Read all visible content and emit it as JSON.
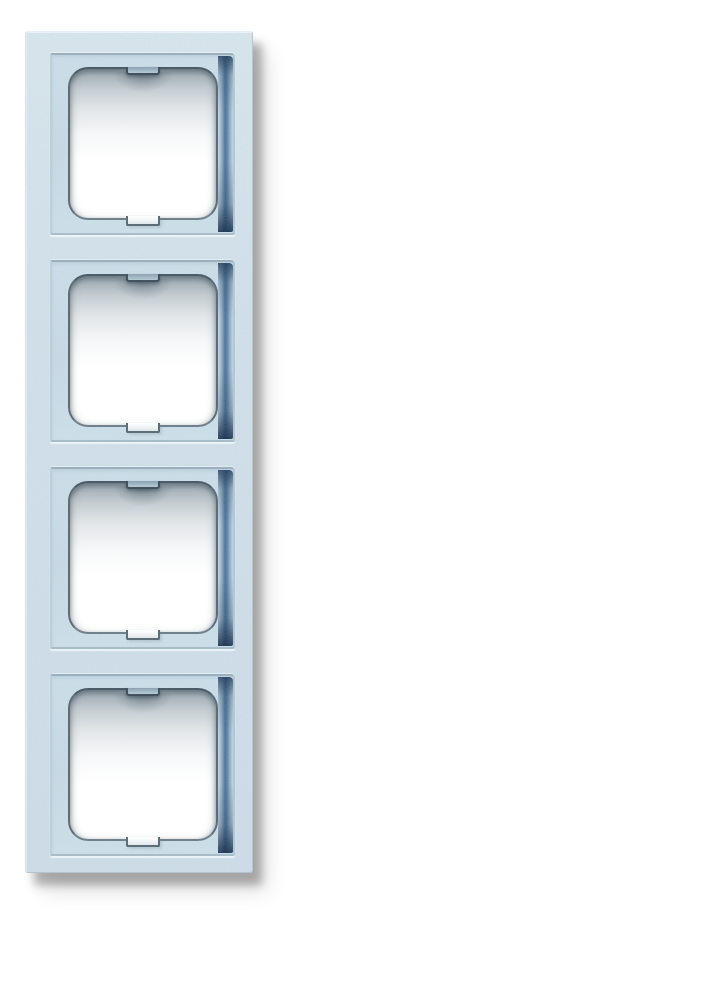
{
  "photo": {
    "subject": "Four-gang vertical cover frame for flush-mounted switches and sockets",
    "description": "Product photo of a light blue-grey (aluminium silver) 4-gang switch frame, vertical orientation, on a plain white background with a soft drop shadow to the bottom right",
    "background_color": "#ffffff",
    "frame": {
      "module_count": 4,
      "orientation": "vertical",
      "opening_shape": "rounded square with small fixing tab at top centre and fixing notch at bottom centre",
      "colors": {
        "frame_surface": "#d3e1ea",
        "frame_surface_light": "#dae7ee",
        "recess_surface": "#cadde8",
        "groove_blue": "#4a6f95",
        "groove_deep_blue": "#15304f",
        "opening_edge": "#54646f",
        "opening_inner_shadow": "#93a1aa",
        "opening_fill": "#ffffff",
        "drop_shadow": "rgba(0,0,0,0.28)"
      },
      "modules": [
        {
          "name": "module-1"
        },
        {
          "name": "module-2"
        },
        {
          "name": "module-3"
        },
        {
          "name": "module-4"
        }
      ]
    }
  }
}
